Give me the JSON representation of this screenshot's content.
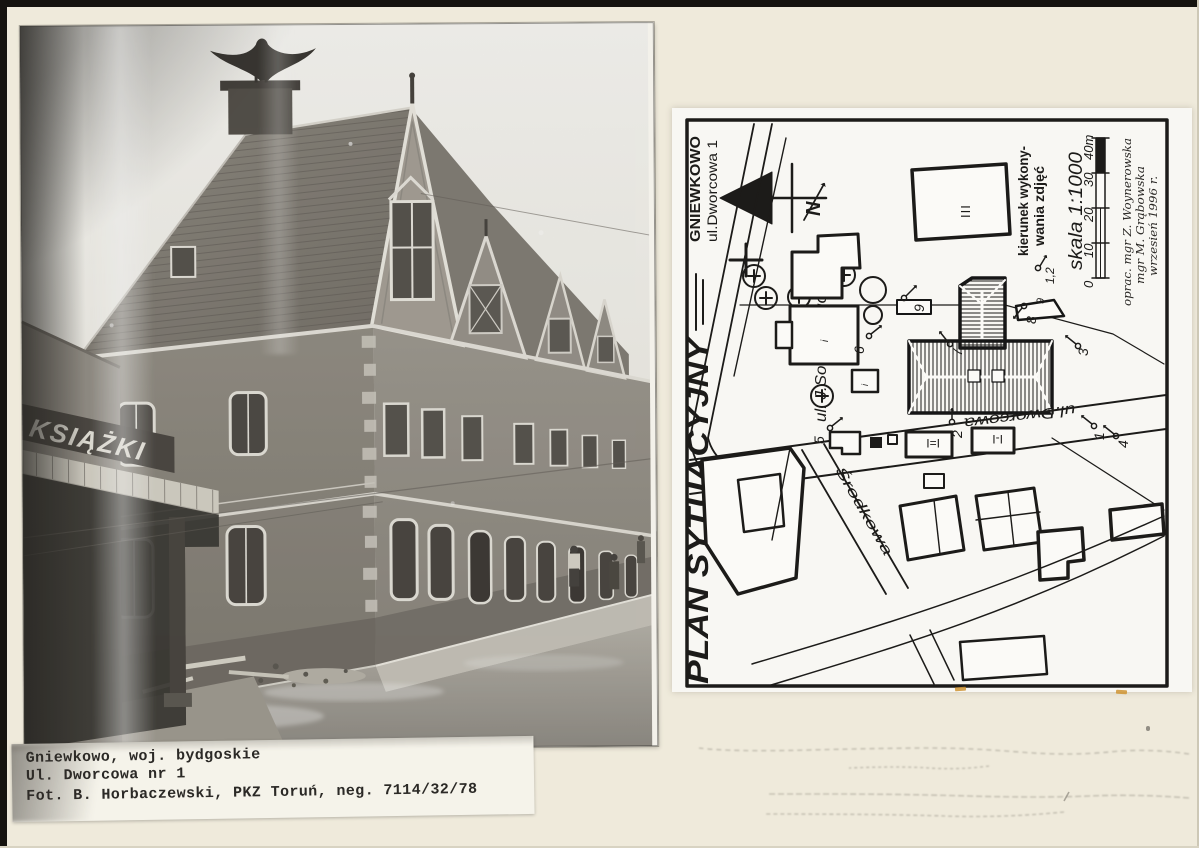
{
  "colors": {
    "page_bg": "#efeadb",
    "scan_edge": "#15130f",
    "plan_paper": "#f8f7f3",
    "plan_ink": "#1c1b19",
    "highlight_orange": "#cf9433"
  },
  "photo": {
    "description": "black-and-white photograph of corner tenement house",
    "sign_text": "KSIĄŻKI"
  },
  "caption": {
    "lines": [
      "Gniewkowo, woj. bydgoskie",
      "Ul. Dworcowa nr 1",
      "Fot. B. Horbaczewski, PKZ Toruń, neg. 7114/32/78"
    ]
  },
  "plan": {
    "title": "PLAN SYTUACYJNY",
    "location": {
      "line1": "GNIEWKOWO",
      "line2": "ul.Dworcowa 1"
    },
    "north_label": "N",
    "streets": {
      "sobieskiego": "ul. J.Sobieskiego",
      "dworcowa": "ul.Dworcowa",
      "srodkowa": "Środkowa"
    },
    "buildings": {
      "iii": "III",
      "i_eq": "I=I",
      "i_dash": "I-I",
      "mark_i": "i"
    },
    "camera_points": {
      "p1": "1",
      "p2": "2",
      "p3": "3",
      "p4": "4",
      "p5": "5",
      "p6": "6",
      "p7": "7",
      "p8": "8",
      "p9": "9",
      "p9b": "9",
      "sample": "1,2"
    },
    "legend": {
      "line1": "kierunek wykony-",
      "line2": "wania zdjęć"
    },
    "scale": {
      "label": "skala 1:1000",
      "ticks": [
        "0",
        "10",
        "20",
        "30",
        "40m"
      ]
    },
    "credits": [
      "oprac. mgr Z. Woynerowska",
      "mgr M. Grąbowska",
      "wrzesień 1996 r."
    ]
  }
}
